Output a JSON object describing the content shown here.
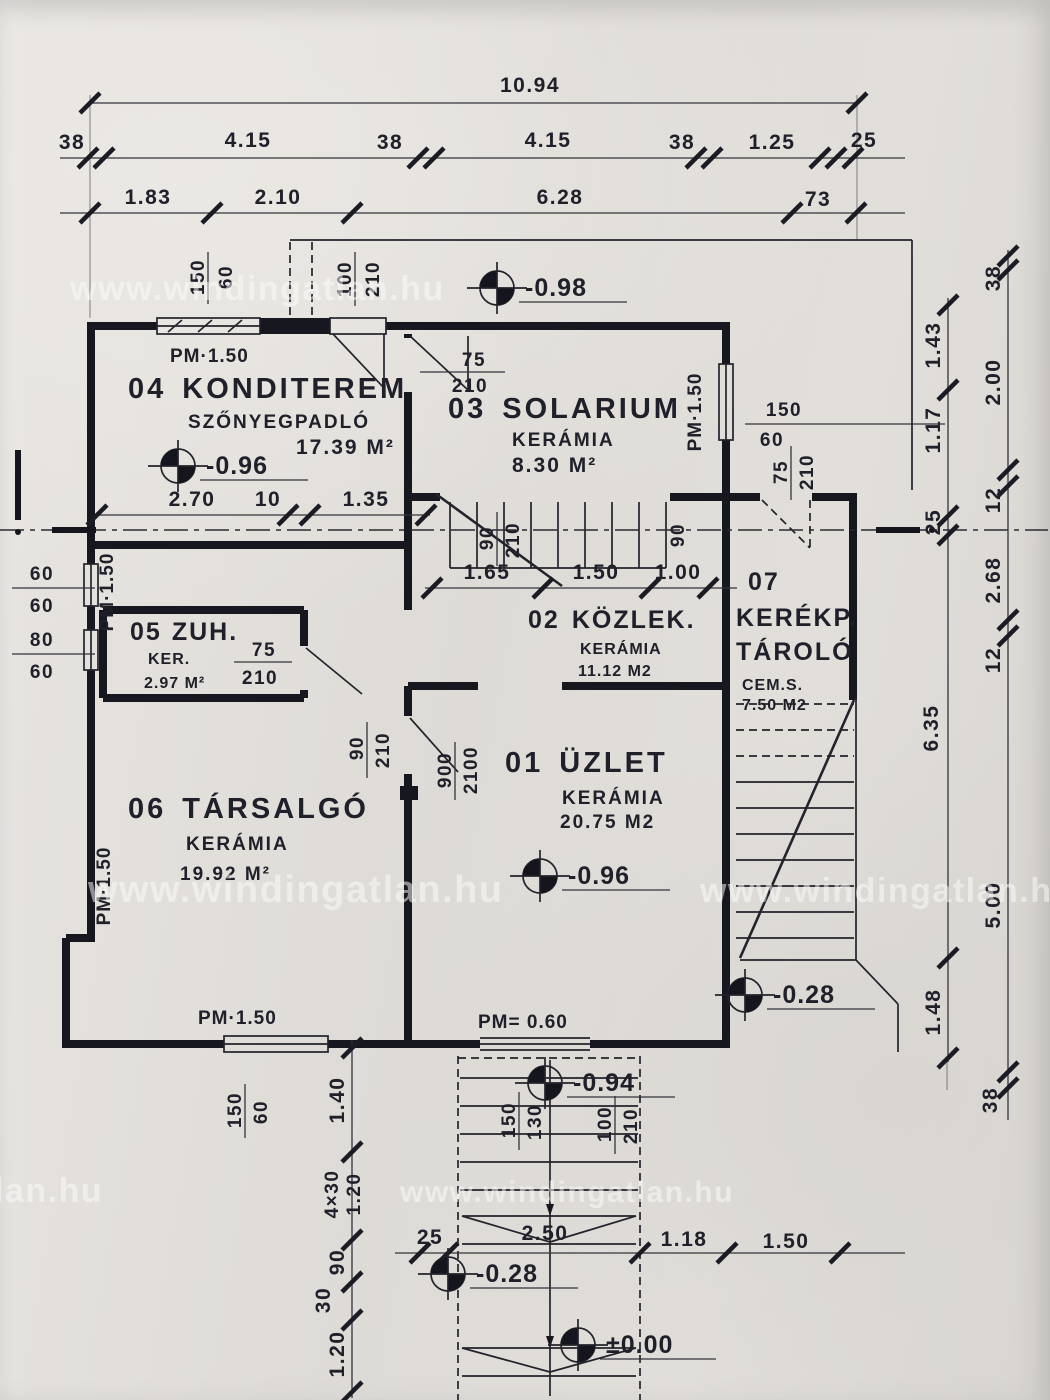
{
  "rooms": {
    "konditerem": {
      "num": "04",
      "name": "KONDITEREM",
      "floor": "SZŐNYEGPADLÓ",
      "area": "17.39 M²"
    },
    "solarium": {
      "num": "03",
      "name": "SOLARIUM",
      "floor": "KERÁMIA",
      "area": "8.30 M²"
    },
    "zuh": {
      "num": "05",
      "name": "ZUH.",
      "floor": "KER.",
      "area": "2.97 M²"
    },
    "kozlek": {
      "num": "02",
      "name": "KÖZLEK.",
      "floor": "KERÁMIA",
      "area": "11.12 M2"
    },
    "kerekparos": {
      "num": "07",
      "name": "KERÉKP.",
      "name2": "TÁROLÓ",
      "floor": "CEM.S.",
      "area": "7.50 M2"
    },
    "tarsalgo": {
      "num": "06",
      "name": "TÁRSALGÓ",
      "floor": "KERÁMIA",
      "area": "19.92 M²"
    },
    "uzlet": {
      "num": "01",
      "name": "ÜZLET",
      "floor": "KERÁMIA",
      "area": "20.75 M2"
    }
  },
  "elevations": {
    "terrace": "-0.98",
    "konditerem": "-0.96",
    "uzlet": "-0.96",
    "right_stair": "-0.28",
    "entry": "-0.94",
    "bottom_stair": "-0.28",
    "ground": "±0.00"
  },
  "parapets": {
    "pm150": "PM·1.50",
    "pm060": "PM= 0.60"
  },
  "sizes": {
    "w150_60": [
      "150",
      "60"
    ],
    "d100_210": [
      "100",
      "210"
    ],
    "d75_210": [
      "75",
      "210"
    ],
    "w60_60": [
      "60",
      "60"
    ],
    "w80_60": [
      "80",
      "60"
    ],
    "d90_210": [
      "90",
      "210"
    ],
    "d90": "90",
    "d900_2100": [
      "900",
      "2100"
    ],
    "e150_130": [
      "150",
      "130"
    ]
  },
  "dims": {
    "top_total": "10.94",
    "top_row2": [
      "38",
      "4.15",
      "38",
      "4.15",
      "38",
      "1.25",
      "25"
    ],
    "top_row3": [
      "1.83",
      "2.10",
      "6.28",
      "73"
    ],
    "right_outer": [
      "38",
      "2.00",
      "12",
      "2.68",
      "12",
      "5.00",
      "38"
    ],
    "right_inner": [
      "1.43",
      "1.17",
      "25",
      "6.35",
      "1.48"
    ],
    "bottom": [
      "25",
      "2.50",
      "1.18",
      "1.50"
    ],
    "left_chain": [
      "1.40",
      "4×30",
      "1.20",
      "90",
      "30",
      "1.20"
    ],
    "konditerem_row": [
      "2.70",
      "10",
      "1.35"
    ],
    "kozlek_row": [
      "1.65",
      "1.50",
      "1.00"
    ]
  },
  "watermark": {
    "text": "www.windingatlan.hu",
    "partial": "lan.hu"
  },
  "colors": {
    "ink": "#1d1d26",
    "paper": "#e3e0dc"
  }
}
